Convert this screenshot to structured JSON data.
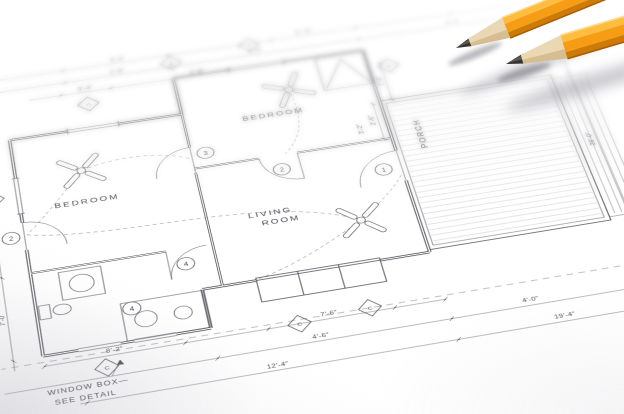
{
  "colors": {
    "paper": "#fefefe",
    "ink": "#4c4c55",
    "ink_light": "#8e8e96",
    "wall": "#42424a",
    "pencil_body": "#f79d15",
    "pencil_body_light": "#ffbd3f",
    "pencil_body_dark": "#cd7a06",
    "pencil_edge_dark": "#a85c03",
    "pencil_wood": "#e9d8b3",
    "pencil_wood_dark": "#d3b98c",
    "pencil_graphite": "#37342f",
    "shadow": "#8f8f99"
  },
  "plan": {
    "rooms": {
      "bedroom1": "BEDROOM",
      "bedroom2": "BEDROOM",
      "living1": "LIVING",
      "living2": "ROOM",
      "porch": "PORCH"
    },
    "note": {
      "line1": "WINDOW BOX—",
      "line2": "SEE DETAIL"
    },
    "window_tags": [
      "A",
      "B",
      "A",
      "B",
      "D",
      "C",
      "C",
      "C"
    ],
    "door_tags": [
      "3",
      "2",
      "1",
      "4",
      "2",
      "4"
    ],
    "dimensions": {
      "top": [
        "9'-6\"",
        "11'-8\"",
        "2'-8\"",
        "3'-0\"",
        "5'-4\"",
        "3'-4\"",
        "2'-8\""
      ],
      "bottom": [
        "8'-2\"",
        "7'-6\"",
        "4'-6\"",
        "4'-0\"",
        "12'-4\"",
        "19'-4\""
      ],
      "left": [
        "12'-6\"",
        "7'-0\""
      ],
      "right": [
        "2'-8\"",
        "26'-0\"",
        "2'-6\"",
        "3'-2\""
      ]
    }
  }
}
